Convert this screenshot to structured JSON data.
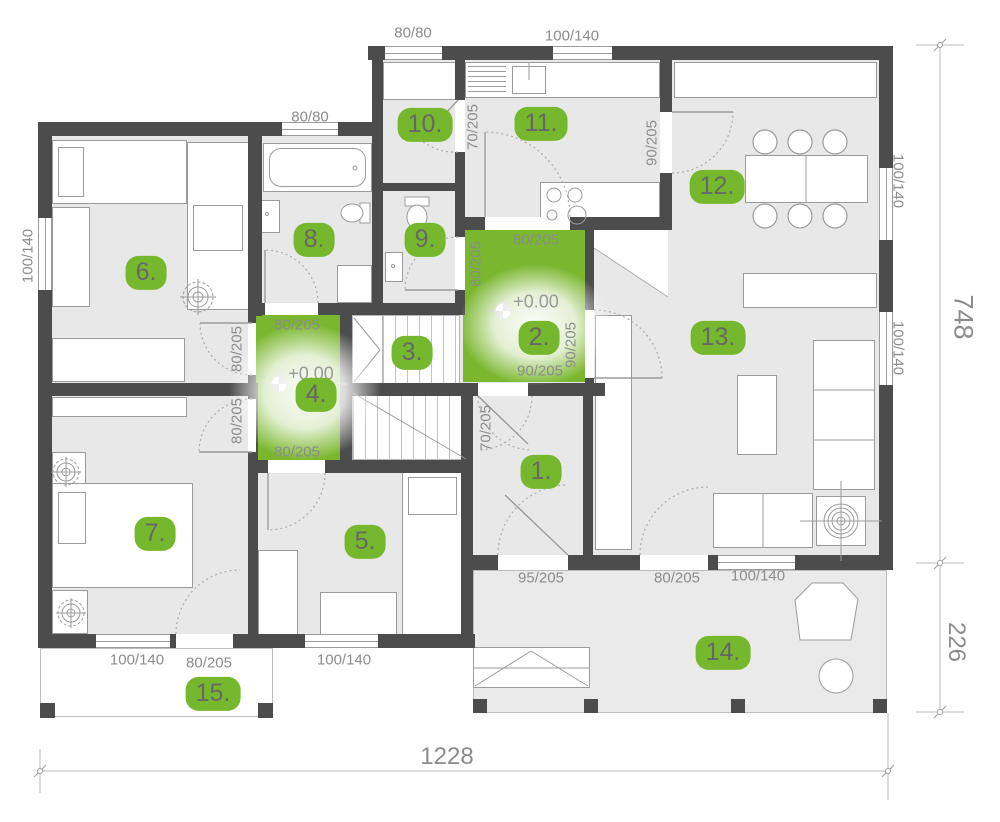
{
  "plan": {
    "badges": [
      {
        "label": "1."
      },
      {
        "label": "2."
      },
      {
        "label": "3."
      },
      {
        "label": "4."
      },
      {
        "label": "5."
      },
      {
        "label": "6."
      },
      {
        "label": "7."
      },
      {
        "label": "8."
      },
      {
        "label": "9."
      },
      {
        "label": "10."
      },
      {
        "label": "11."
      },
      {
        "label": "12."
      },
      {
        "label": "13."
      },
      {
        "label": "14."
      },
      {
        "label": "15."
      }
    ],
    "labels": [
      {
        "text": "80/80"
      },
      {
        "text": "100/140"
      },
      {
        "text": "80/80"
      },
      {
        "text": "100/140"
      },
      {
        "text": "70/205"
      },
      {
        "text": "90/205"
      },
      {
        "text": "100/140"
      },
      {
        "text": "100/140"
      },
      {
        "text": "80/205"
      },
      {
        "text": "80/205"
      },
      {
        "text": "90/205"
      },
      {
        "text": "90/205"
      },
      {
        "text": "+0.00"
      },
      {
        "text": "80/205"
      },
      {
        "text": "80/205"
      },
      {
        "text": "+0.00"
      },
      {
        "text": "80/205"
      },
      {
        "text": "80/205"
      },
      {
        "text": "70/205"
      },
      {
        "text": "95/205"
      },
      {
        "text": "80/205"
      },
      {
        "text": "100/140"
      },
      {
        "text": "100/140"
      },
      {
        "text": "80/205"
      },
      {
        "text": "100/140"
      }
    ],
    "overall": {
      "width": "1228",
      "depth_main": "748",
      "depth_front": "226"
    },
    "colors": {
      "badge_green": "#76b82d",
      "room_highlight_green": "#7ab72e",
      "wall_gray": "#4c4c4c",
      "floor_gray": "#e8e8e8",
      "dimension_text_gray": "#8c8c8c"
    }
  }
}
